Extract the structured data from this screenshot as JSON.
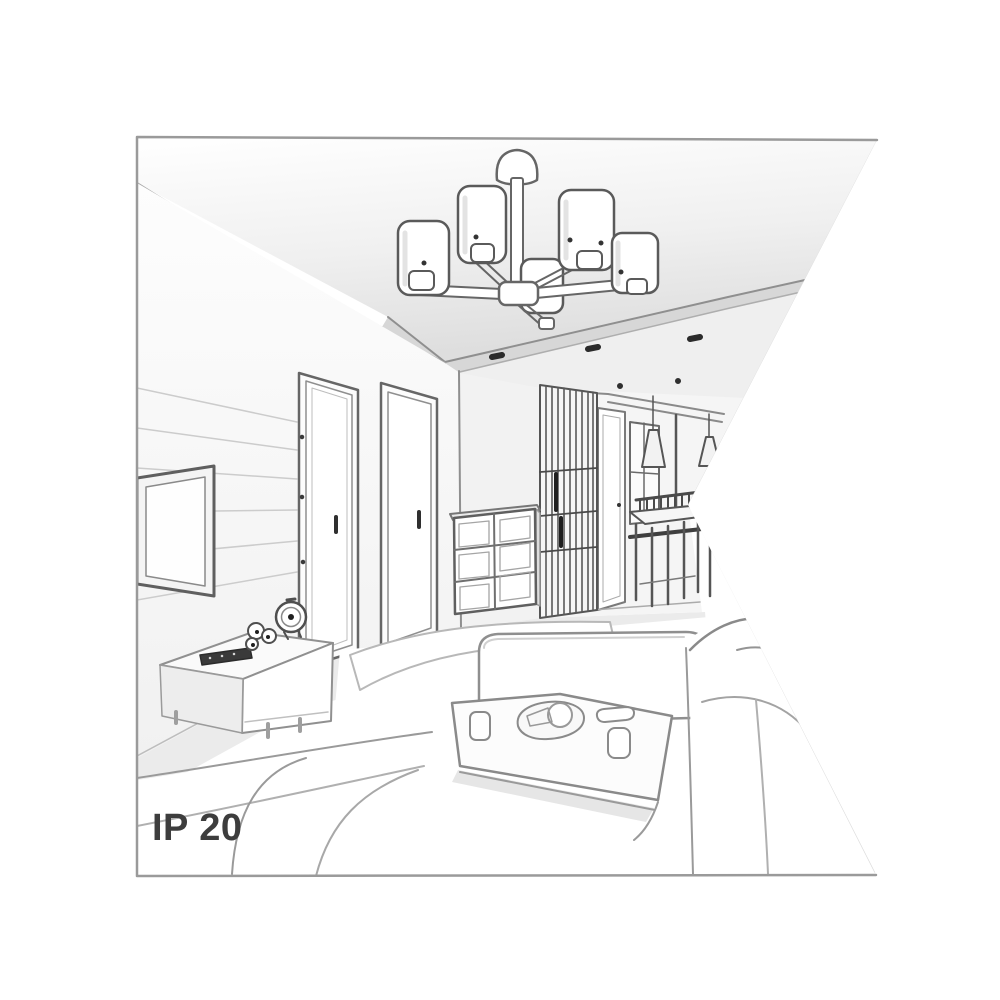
{
  "meta": {
    "description": "Grayscale perspective line drawing of a living room interior, clipped to a square frame with a triangular notch cut into the right edge",
    "style": "line art illustration"
  },
  "labels": {
    "ip_rating": "IP 20"
  },
  "colors": {
    "background": "#ffffff",
    "frame_border": "#9a9a9a",
    "line": "#5f5f5f",
    "dark_detail": "#2b2b2b",
    "shade_light": "#ececec",
    "shade_mid": "#d7d7d7",
    "text": "#3d3d3d"
  },
  "scene": {
    "objects": [
      "ceiling chandelier with cylindrical shades",
      "recessed ceiling spotlights",
      "wall-mounted tv",
      "media console with alarm clock, figurines and remote",
      "two interior doors",
      "chest of drawers",
      "slatted wardrobe",
      "hallway with white door and window",
      "dining table with chairs",
      "cone pendant lamps",
      "sectional sofa",
      "armchair",
      "coffee table with cups, bowl and dish"
    ]
  }
}
